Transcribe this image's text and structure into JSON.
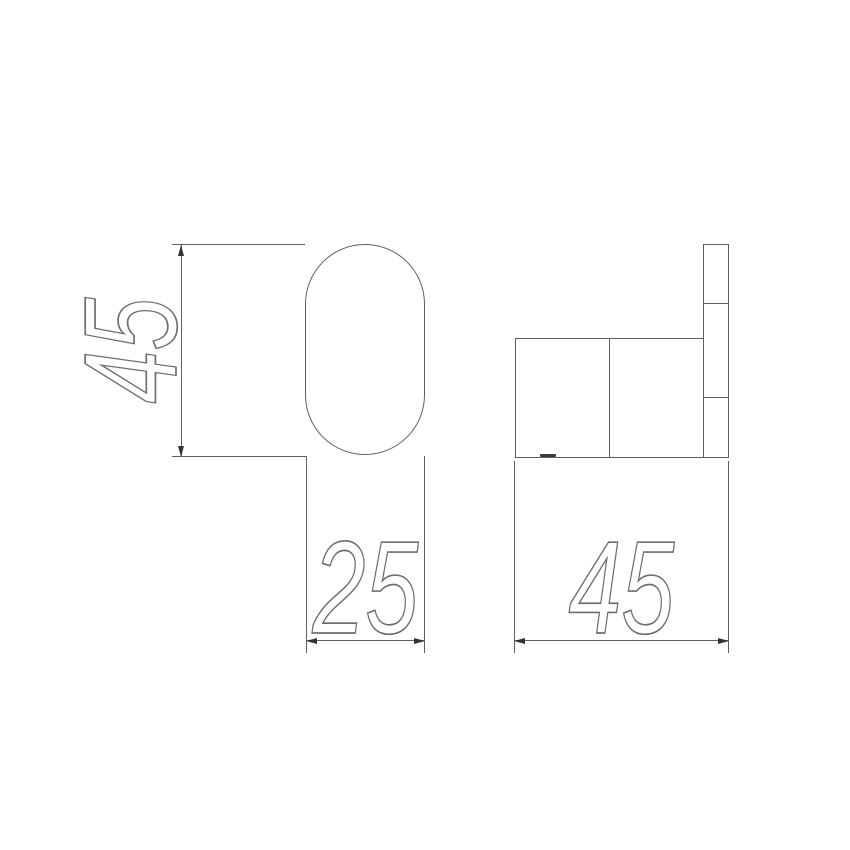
{
  "page": {
    "background": "#ffffff"
  },
  "drawing": {
    "type": "technical-orthographic-views",
    "subject": "wall hook product dimension drawing, front view (capsule outline) and side view",
    "line_color": "#5f5f5f",
    "arrow_color": "#333333",
    "text_outline_color": "#6e6e6e",
    "dimensions": {
      "front_height": {
        "value": "45",
        "orientation": "vertical",
        "units": "mm (implied)"
      },
      "front_width": {
        "value": "25",
        "orientation": "horizontal",
        "units": "mm (implied)"
      },
      "side_depth": {
        "value": "45",
        "orientation": "horizontal",
        "units": "mm (implied)"
      }
    }
  }
}
